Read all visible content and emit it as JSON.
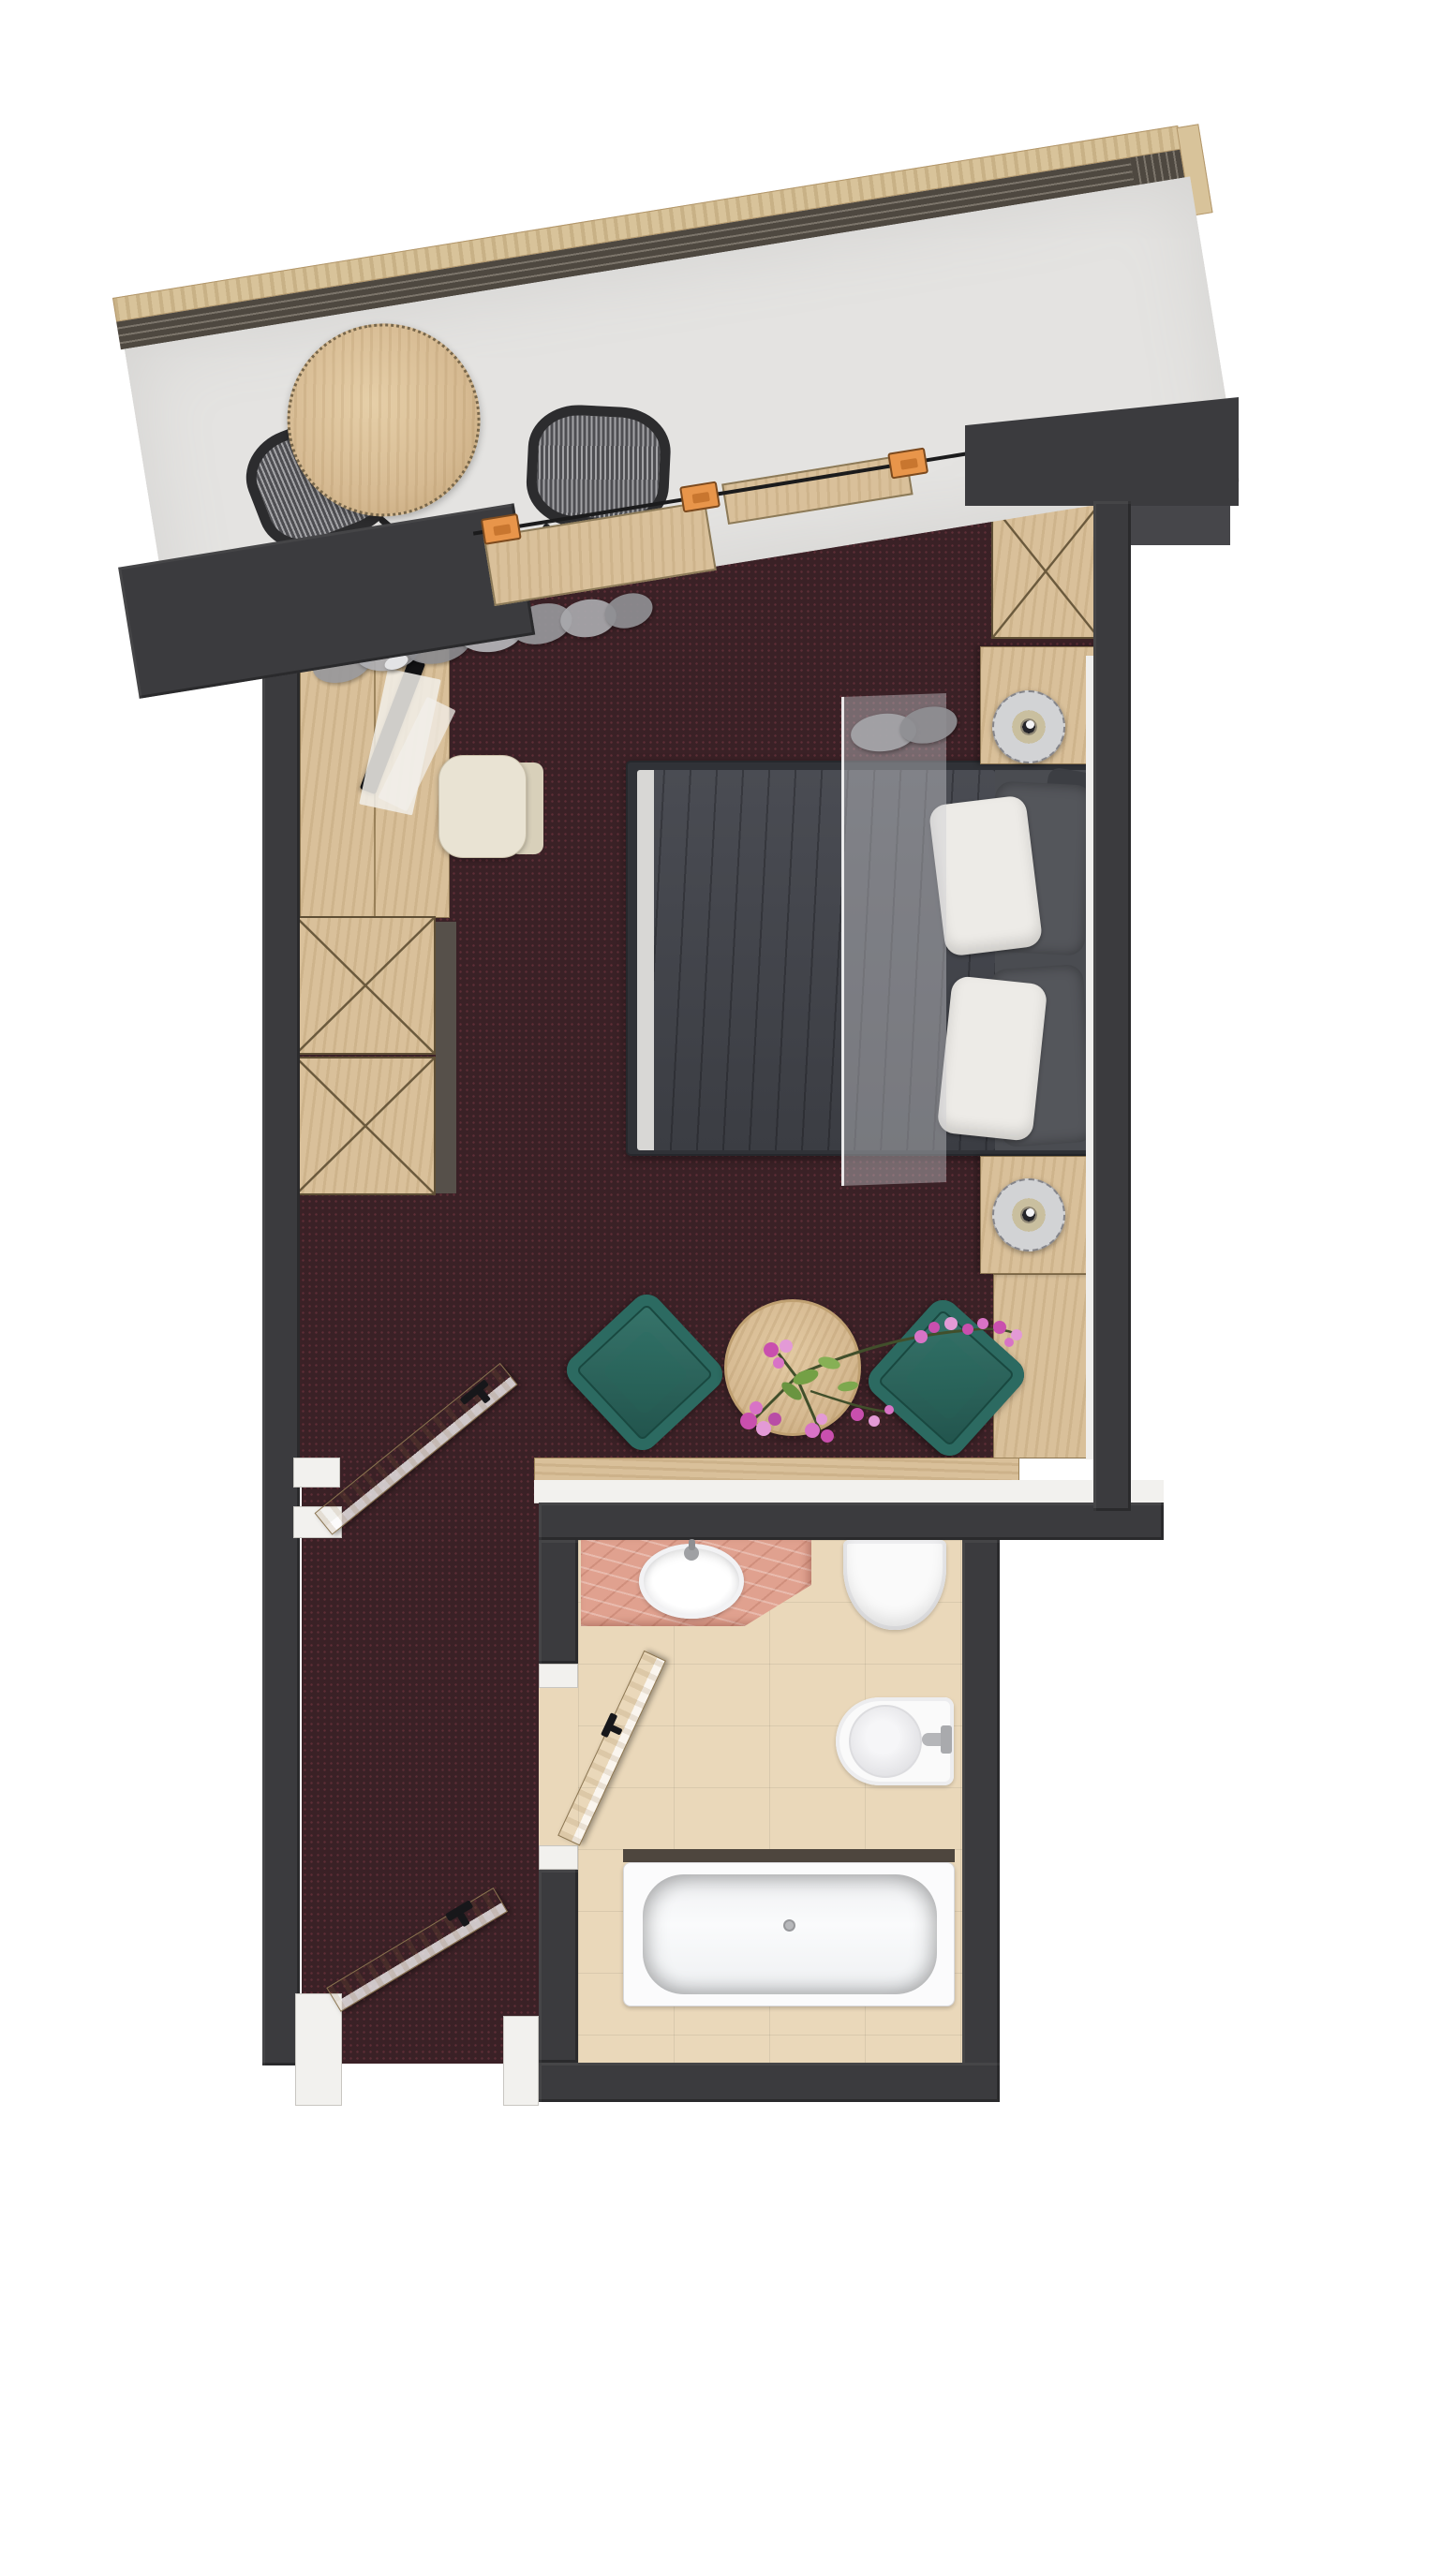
{
  "title": "Hotel room floor plan (top-down 3D render)",
  "rooms": [
    "balcony",
    "bedroom",
    "corridor",
    "bathroom"
  ],
  "colors": {
    "wall": "#3b3b3e",
    "carpet": "#3a2126",
    "carpetDot": "#5d2e36",
    "balconyFloor": "#e4e3e1",
    "railingWood": "#d8c39a",
    "railingDark": "#4e4840",
    "woodLight": "#d9c09a",
    "tableWood": "#d6ba92",
    "doorWood": "#d6bc92",
    "doorEdge": "#dedbd4",
    "jambWhite": "#f2f1ee",
    "duvet": "#43454b",
    "bedFrame": "#303237",
    "pillowWhite": "#edebe7",
    "pillowGray": "#54565b",
    "sheet": "#d8d7d5",
    "sheer": "rgba(205,206,210,0.42)",
    "teal": "#2c6a61",
    "tealLight": "#39786e",
    "tealDark": "#1f5049",
    "bathFloor": "#ead8ba",
    "vanityPink": "#e0a18f",
    "fixtureWhite": "#fafafa",
    "fixtureShade": "#cfcfd3",
    "tubLedge": "#4e463e",
    "clipOrange": "#e8954a",
    "lampSilver": "#d2d3d5",
    "lampCenter": "#25252a",
    "tv": "#121214",
    "chairCream": "#e9e3d3",
    "chairWeaveDark": "#2c2c2e",
    "flowerPink": "#c94fae",
    "flowerPinkLight": "#e39ad6",
    "leafGreen": "#74a045",
    "stemGreen": "#414f2b"
  },
  "furniture": {
    "patio_table": "round wooden patio table",
    "patio_chair": "woven patio chair",
    "railing": "wood-capped balcony railing",
    "desk": "wooden desk console with TV",
    "desk_chair": "cream desk chair",
    "wardrobe": "cross-front wardrobe unit",
    "corner_cabinet": "cross-front corner cabinet",
    "bed": "double bed with charcoal duvet",
    "nightstand": "nightstand with round metal lamp",
    "teal_chair": "teal lounge chair",
    "coffee_table": "round coffee table with pink flowers",
    "vanity": "pink stone vanity with oval basin",
    "toilet": "toilet",
    "bidet": "bidet",
    "bathtub": "built-in bathtub",
    "door": "open wooden door"
  }
}
